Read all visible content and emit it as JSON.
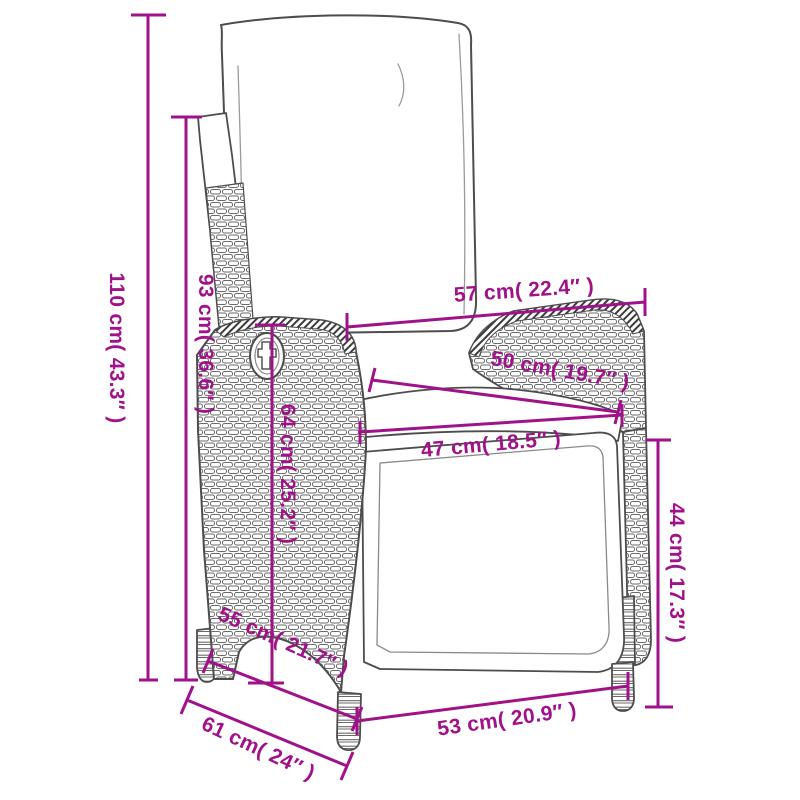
{
  "diagram": {
    "kind": "product-dimension-drawing",
    "subject": "reclining poly rattan garden chair with cushions, line-art side/front view",
    "accent_color": "#A0128A",
    "outline_color": "#4d4d4d",
    "background": "#ffffff"
  },
  "dimensions": [
    {
      "id": "overall-height",
      "cm": 110,
      "inches": 43.3,
      "label": "110 cm( 43.3″ )"
    },
    {
      "id": "backrest-height",
      "cm": 93,
      "inches": 36.6,
      "label": "93 cm( 36.6″ )"
    },
    {
      "id": "back-width",
      "cm": 57,
      "inches": 22.4,
      "label": "57 cm( 22.4″ )"
    },
    {
      "id": "armrest-width",
      "cm": 50,
      "inches": 19.7,
      "label": "50 cm( 19.7″ )"
    },
    {
      "id": "seat-width",
      "cm": 47,
      "inches": 18.5,
      "label": "47 cm( 18.5″ )"
    },
    {
      "id": "side-height",
      "cm": 64,
      "inches": 25.2,
      "label": "64 cm( 25.2″ )"
    },
    {
      "id": "front-height",
      "cm": 44,
      "inches": 17.3,
      "label": "44 cm( 17.3″ )"
    },
    {
      "id": "seat-depth",
      "cm": 55,
      "inches": 21.7,
      "label": "55 cm( 21.7″ )"
    },
    {
      "id": "overall-depth",
      "cm": 61,
      "inches": 24,
      "label": "61 cm( 24″ )"
    },
    {
      "id": "front-width",
      "cm": 53,
      "inches": 20.9,
      "label": "53 cm( 20.9″ )"
    }
  ]
}
